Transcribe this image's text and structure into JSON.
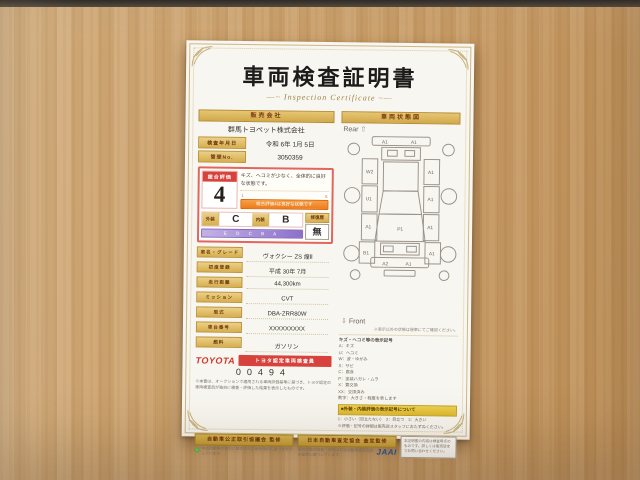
{
  "certificate": {
    "title": "車両検査証明書",
    "subtitle": "Inspection Certificate",
    "subtitle_prefix": "—~",
    "subtitle_suffix": "~—",
    "seller": {
      "header": "販売会社",
      "name": "群馬トヨペット株式会社",
      "rows": [
        {
          "label": "検査年月日",
          "value": "令和 6年 1月 5日"
        },
        {
          "label": "管理No.",
          "value": "3050359"
        }
      ]
    },
    "evaluation": {
      "overall_label": "総合評価",
      "overall_score": "4",
      "comment": "キズ、ヘコミが少なく、全体的に良好な状態です。",
      "scale_min": "1",
      "scale_max": "S",
      "scale_caption": "総合評価4は良好な状態です",
      "exterior_label": "外装",
      "exterior_grade": "C",
      "interior_label": "内装",
      "interior_grade": "B",
      "grade_scale": "E D C B A",
      "repair_label": "修復歴",
      "repair_value": "無"
    },
    "spec_rows": [
      {
        "label": "車名・グレード",
        "value": "ヴォクシー ZS 煌Ⅱ"
      },
      {
        "label": "初度登録",
        "value": "平成 30年 7月"
      },
      {
        "label": "走行距離",
        "value": "44,300km"
      },
      {
        "label": "ミッション",
        "value": "CVT"
      },
      {
        "label": "型式",
        "value": "DBA-ZRR80W"
      },
      {
        "label": "車台番号",
        "value": "XXXXXXXXX"
      },
      {
        "label": "燃料",
        "value": "ガソリン"
      }
    ],
    "inspector": {
      "brand": "TOYOTA",
      "badge": "トヨタ認定車両検査員",
      "number": "00494",
      "disclaimer": "※本書は、オークションで適用される車両評価基準に基づき、トヨタ認定の車両検査員が独自に検査・評価した結果を表示したものです。"
    },
    "diagram": {
      "header": "車両状態図",
      "rear_label": "Rear",
      "front_label": "Front",
      "rear_arrow": "⇧",
      "front_arrow": "⇩",
      "note": "※表示以外の状態は現車にてご確認ください。",
      "marks": {
        "rear_bumper_l": "A1",
        "rear_bumper_r": "A1",
        "rear_quarter_l": "W2",
        "rear_quarter_r": "A1",
        "rear_door_l": "U1",
        "rear_door_r": "A1",
        "front_door_l": "A1",
        "front_door_r": "A1",
        "fender_l": "B1",
        "fender_r": "A1",
        "hood": "P1",
        "front_bumper_l": "A2",
        "front_bumper_r": "A1"
      }
    },
    "legend": {
      "title": "キズ・ヘコミ等の表示記号",
      "items": [
        "A：キズ",
        "U：ヘコミ",
        "W：波・ゆがみ",
        "S：サビ",
        "C：腐食",
        "P：塗装ハガレ・ムラ",
        "X：要交換",
        "XX：交換済み",
        "数字：大きさ・程度を表します"
      ],
      "symbol_header": "■外装・内装評価の表示記号について",
      "symbol_note1": "1：小さい（目立たない）　2：目立つ　3：大きい",
      "symbol_note2": "※評価・記号の詳細は販売店スタッフにおたずねください。"
    },
    "footer": {
      "left_title": "自動車公正取引協議会 監修",
      "left_note": "中古自動車の表示に関する公正競争規約に基づき表示しています。",
      "right_title": "日本自動車査定協会 査定監修",
      "right_note": "車両状態の検査・評価は日本自動車査定協会の基準に基づいています。",
      "jaai_logo": "JAAI",
      "side_note": "本証明書の内容は検査時点のものです。詳しくは販売店までお問い合わせください。"
    }
  }
}
